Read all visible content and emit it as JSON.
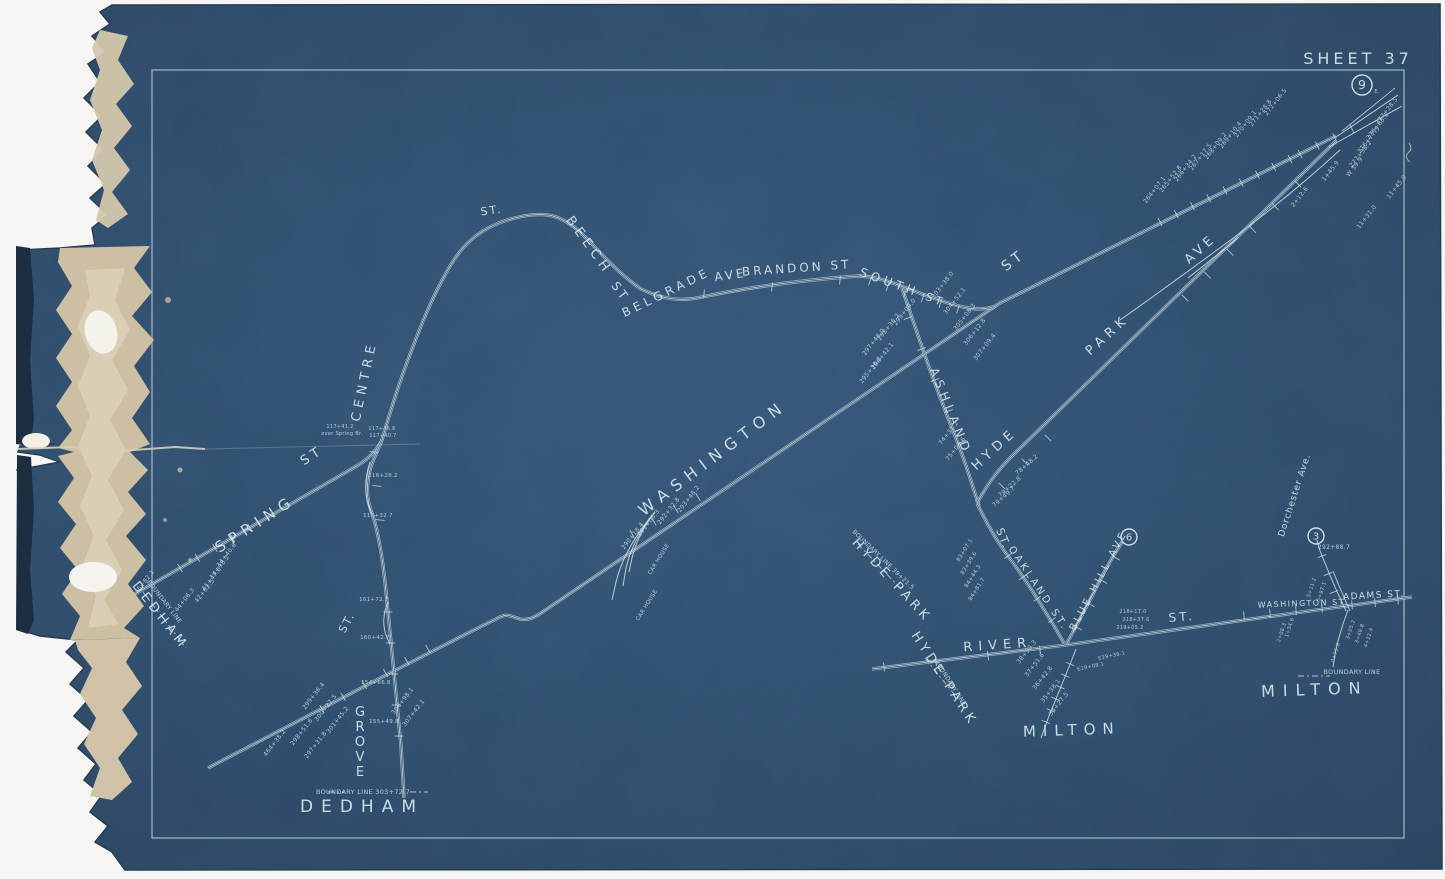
{
  "sheet": {
    "title": "SHEET 37"
  },
  "colors": {
    "blueprint_blue": "#2a4a68",
    "line_white": "#d9e5ea",
    "torn_paper_tan": "#cdbfa2",
    "background_white": "#f6f5f1"
  },
  "route_markers": [
    {
      "label": "9",
      "x": 1362,
      "y": 85,
      "r": 10
    },
    {
      "label": "6",
      "x": 1129,
      "y": 537,
      "r": 8
    },
    {
      "label": "3",
      "x": 1316,
      "y": 536,
      "r": 8
    }
  ],
  "labels": [
    {
      "text": "SPRING",
      "x": 258,
      "y": 528,
      "rot": -33,
      "size": 15,
      "ls": 6,
      "name": "label-spring-st"
    },
    {
      "text": "ST",
      "x": 314,
      "y": 459,
      "rot": -33,
      "size": 13,
      "ls": 4,
      "name": "label-spring-st-suffix"
    },
    {
      "text": "CENTRE",
      "x": 368,
      "y": 382,
      "rot": -78,
      "size": 13,
      "ls": 5,
      "name": "label-centre-st"
    },
    {
      "text": "ST.",
      "x": 350,
      "y": 624,
      "rot": -62,
      "size": 11,
      "ls": 2,
      "name": "label-centre-st-suffix"
    },
    {
      "text": "ST.",
      "x": 492,
      "y": 214,
      "rot": -8,
      "size": 11,
      "ls": 2,
      "name": "label-beech-st-prefix"
    },
    {
      "text": "BEECH",
      "x": 586,
      "y": 248,
      "rot": 54,
      "size": 13,
      "ls": 5,
      "name": "label-beech-st"
    },
    {
      "text": "ST",
      "x": 617,
      "y": 294,
      "rot": 54,
      "size": 12,
      "ls": 3,
      "name": "label-beech-st-suffix"
    },
    {
      "text": "BELGRADE",
      "x": 668,
      "y": 296,
      "rot": -26,
      "size": 12,
      "ls": 4,
      "name": "label-belgrade-ave"
    },
    {
      "text": "AVE",
      "x": 731,
      "y": 279,
      "rot": -8,
      "size": 12,
      "ls": 3,
      "name": "label-belgrade-ave-suffix"
    },
    {
      "text": "BRANDON ST",
      "x": 797,
      "y": 272,
      "rot": -4,
      "size": 12,
      "ls": 3,
      "name": "label-brandon-st"
    },
    {
      "text": "SOUTH",
      "x": 888,
      "y": 286,
      "rot": 20,
      "size": 12,
      "ls": 4,
      "name": "label-south-st"
    },
    {
      "text": "ST",
      "x": 934,
      "y": 303,
      "rot": 20,
      "size": 11,
      "ls": 3,
      "name": "label-south-st-suffix"
    },
    {
      "text": "WASHINGTON",
      "x": 716,
      "y": 462,
      "rot": -37,
      "size": 16,
      "ls": 7,
      "name": "label-washington-st"
    },
    {
      "text": "ST",
      "x": 1016,
      "y": 264,
      "rot": -37,
      "size": 14,
      "ls": 4,
      "name": "label-washington-st-suffix"
    },
    {
      "text": "ASHLAND",
      "x": 947,
      "y": 413,
      "rot": 68,
      "size": 12,
      "ls": 5,
      "name": "label-ashland-st"
    },
    {
      "text": "ST.",
      "x": 1000,
      "y": 540,
      "rot": 68,
      "size": 11,
      "ls": 2,
      "name": "label-ashland-st-suffix"
    },
    {
      "text": "HYDE",
      "x": 997,
      "y": 452,
      "rot": -42,
      "size": 13,
      "ls": 5,
      "name": "label-hyde-park-ave"
    },
    {
      "text": "PARK",
      "x": 1110,
      "y": 338,
      "rot": -42,
      "size": 13,
      "ls": 5,
      "name": "label-hyde-park-ave-2"
    },
    {
      "text": "AVE",
      "x": 1203,
      "y": 252,
      "rot": -42,
      "size": 13,
      "ls": 4,
      "name": "label-hyde-park-ave-3"
    },
    {
      "text": "OAKLAND ST.",
      "x": 1036,
      "y": 590,
      "rot": 56,
      "size": 10,
      "ls": 3,
      "name": "label-oakland-st"
    },
    {
      "text": "BLUE HILL AVE",
      "x": 1101,
      "y": 582,
      "rot": -62,
      "size": 10,
      "ls": 3,
      "name": "label-blue-hill-ave"
    },
    {
      "text": "RIVER",
      "x": 998,
      "y": 649,
      "rot": -4,
      "size": 13,
      "ls": 6,
      "name": "label-river-st"
    },
    {
      "text": "ST.",
      "x": 1182,
      "y": 621,
      "rot": -4,
      "size": 12,
      "ls": 3,
      "name": "label-river-st-suffix"
    },
    {
      "text": "WASHINGTON ST.",
      "x": 1303,
      "y": 606,
      "rot": -2,
      "size": 8,
      "ls": 1.5,
      "name": "label-washington-st-milton"
    },
    {
      "text": "ADAMS ST.",
      "x": 1374,
      "y": 598,
      "rot": -3,
      "size": 9,
      "ls": 1.5,
      "name": "label-adams-st"
    },
    {
      "text": "Dorchester Ave.",
      "x": 1297,
      "y": 496,
      "rot": -72,
      "size": 9,
      "ls": 1,
      "name": "label-dorchester-ave"
    },
    {
      "text": "GROVE",
      "x": 360,
      "y": 716,
      "size": 13,
      "stack": true,
      "name": "label-grove-st"
    },
    {
      "text": "DEDHAM",
      "x": 157,
      "y": 618,
      "rot": 52,
      "size": 13,
      "ls": 4,
      "name": "label-dedham-left"
    },
    {
      "text": "DEDHAM",
      "x": 362,
      "y": 812,
      "rot": 0,
      "size": 17,
      "ls": 8,
      "name": "label-dedham-bottom"
    },
    {
      "text": "HYDE PARK",
      "x": 889,
      "y": 583,
      "rot": 47,
      "size": 13,
      "ls": 4,
      "name": "label-hyde-park-upper"
    },
    {
      "text": "HYDE PARK",
      "x": 941,
      "y": 681,
      "rot": 57,
      "size": 13,
      "ls": 4,
      "name": "label-hyde-park-lower"
    },
    {
      "text": "MILTON",
      "x": 1072,
      "y": 735,
      "rot": -2,
      "size": 15,
      "ls": 7,
      "name": "label-milton-center"
    },
    {
      "text": "MILTON",
      "x": 1315,
      "y": 695,
      "rot": -2,
      "size": 16,
      "ls": 8,
      "name": "label-milton-right"
    }
  ],
  "notes": [
    {
      "text": "BOUNDARY LINE",
      "x": 163,
      "y": 603,
      "rot": 52,
      "size": 6
    },
    {
      "text": "BOUNDARY LINE 303+72.7",
      "x": 363,
      "y": 794,
      "rot": 0,
      "size": 6.5
    },
    {
      "text": "BOUNDARY LINE",
      "x": 1352,
      "y": 674,
      "rot": 0,
      "size": 6.5
    },
    {
      "text": "BOUNDARY LINE 39+21.5",
      "x": 882,
      "y": 561,
      "rot": 44,
      "size": 6
    },
    {
      "text": "BOUNDARY LINE",
      "x": 949,
      "y": 684,
      "rot": 57,
      "size": 6
    },
    {
      "text": "CAR HOUSE",
      "x": 660,
      "y": 560,
      "rot": -58,
      "size": 5.5
    },
    {
      "text": "CAR HOUSE",
      "x": 648,
      "y": 606,
      "rot": -58,
      "size": 5.5
    },
    {
      "text": "over Spring Br.",
      "x": 342,
      "y": 435,
      "rot": 0,
      "size": 5
    }
  ],
  "stations": [
    [
      "E.",
      1377,
      93,
      0,
      5
    ],
    [
      "277+28.5",
      1388,
      112
    ],
    [
      "276+88.1",
      1379,
      127
    ],
    [
      "276+77.5",
      1370,
      141
    ],
    [
      "277+38.2",
      1362,
      155
    ],
    [
      "W 59.9",
      1356,
      168
    ],
    [
      "11+45.9",
      1398,
      188
    ],
    [
      "11+31.0",
      1368,
      218
    ],
    [
      "272+06.5",
      1277,
      103
    ],
    [
      "271+28.8",
      1262,
      114
    ],
    [
      "270+09.1",
      1247,
      125
    ],
    [
      "269+10.4",
      1232,
      136
    ],
    [
      "268+09.2",
      1217,
      147
    ],
    [
      "267+17.5",
      1202,
      158
    ],
    [
      "266+34.2",
      1187,
      169
    ],
    [
      "265+52.8",
      1172,
      180
    ],
    [
      "264+07.1",
      1156,
      191
    ],
    [
      "1+45.9",
      1332,
      172
    ],
    [
      "2+12.6",
      1301,
      198
    ],
    [
      "299+09.0",
      906,
      313
    ],
    [
      "298+36.2",
      890,
      328
    ],
    [
      "297+48.0",
      875,
      343
    ],
    [
      "296+42.1",
      884,
      357
    ],
    [
      "295+36.8",
      872,
      371
    ],
    [
      "303+38.0",
      944,
      286
    ],
    [
      "304+52.1",
      956,
      302
    ],
    [
      "305+08.3",
      966,
      318
    ],
    [
      "306+12.8",
      976,
      333
    ],
    [
      "307+09.4",
      986,
      348
    ],
    [
      "74+31.2",
      950,
      434
    ],
    [
      "75+08.6",
      957,
      450
    ],
    [
      "78+48.2",
      1028,
      466,
      -42
    ],
    [
      "79+22.8",
      1011,
      488,
      -42
    ],
    [
      "79+49.7",
      1005,
      498,
      -42
    ],
    [
      "293+48.2",
      690,
      500
    ],
    [
      "292+32.8",
      670,
      512
    ],
    [
      "291+05.3",
      650,
      524
    ],
    [
      "290+18.4",
      634,
      537
    ],
    [
      "14+40.6",
      228,
      556
    ],
    [
      "14+98.2",
      221,
      568
    ],
    [
      "41+47.0",
      213,
      580
    ],
    [
      "42+62.5",
      206,
      592
    ],
    [
      "44+06.3",
      186,
      601
    ],
    [
      "45+82.1",
      146,
      583
    ],
    [
      "117+41.2",
      340,
      428,
      0,
      5
    ],
    [
      "117+46.6",
      382,
      430,
      0,
      5
    ],
    [
      "117+40.7",
      383,
      437,
      0,
      5
    ],
    [
      "116+28.2",
      383,
      477,
      0,
      5.5
    ],
    [
      "115+32.7",
      378,
      517,
      0,
      5.5
    ],
    [
      "161+72.7",
      374,
      601,
      0,
      5.5
    ],
    [
      "160+42.7",
      375,
      639,
      0,
      5.5
    ],
    [
      "154+66.8",
      376,
      684,
      0,
      5.5
    ],
    [
      "155+49.8",
      384,
      723,
      0,
      5.5
    ],
    [
      "306+98.1",
      404,
      702
    ],
    [
      "307+42.1",
      415,
      714
    ],
    [
      "299+36.4",
      315,
      697
    ],
    [
      "300+27.5",
      327,
      709
    ],
    [
      "301+45.2",
      339,
      721
    ],
    [
      "297+31.8",
      317,
      746
    ],
    [
      "298+51.6",
      303,
      733
    ],
    [
      "464+38.2",
      276,
      744
    ],
    [
      "218+17.0",
      1133,
      613,
      0,
      5
    ],
    [
      "218+37.6",
      1136,
      621,
      0,
      5
    ],
    [
      "219+05.2",
      1130,
      629,
      0,
      5
    ],
    [
      "83+07.1",
      966,
      551,
      -58,
      5.5
    ],
    [
      "83+39.6",
      970,
      564,
      -58,
      5.5
    ],
    [
      "84+44.3",
      974,
      577,
      -58,
      5.5
    ],
    [
      "84+81.7",
      978,
      590,
      -58,
      5.5
    ],
    [
      "38+59.3",
      1028,
      653
    ],
    [
      "37+51.6",
      1036,
      666
    ],
    [
      "36+42.8",
      1044,
      679
    ],
    [
      "35+38.1",
      1052,
      692
    ],
    [
      "34+27.5",
      1060,
      705
    ],
    [
      "E19+36.1",
      1112,
      657,
      -12,
      5
    ],
    [
      "E19+08.1",
      1091,
      668,
      -12,
      5
    ],
    [
      "292+88.7",
      1334,
      549,
      0,
      6
    ],
    [
      "5+11.2",
      1313,
      588,
      -72,
      5
    ],
    [
      "5+97.1",
      1323,
      592,
      -72,
      5
    ],
    [
      "1+34.6",
      1291,
      628,
      -72,
      5
    ],
    [
      "2+08.3",
      1283,
      633,
      -72,
      5
    ],
    [
      "3+05.2",
      1352,
      630,
      -72,
      5
    ],
    [
      "3+49.8",
      1361,
      634,
      -72,
      5
    ],
    [
      "4+12.4",
      1370,
      638,
      -72,
      5
    ],
    [
      "0+75.0",
      1337,
      653,
      -72,
      5
    ]
  ]
}
